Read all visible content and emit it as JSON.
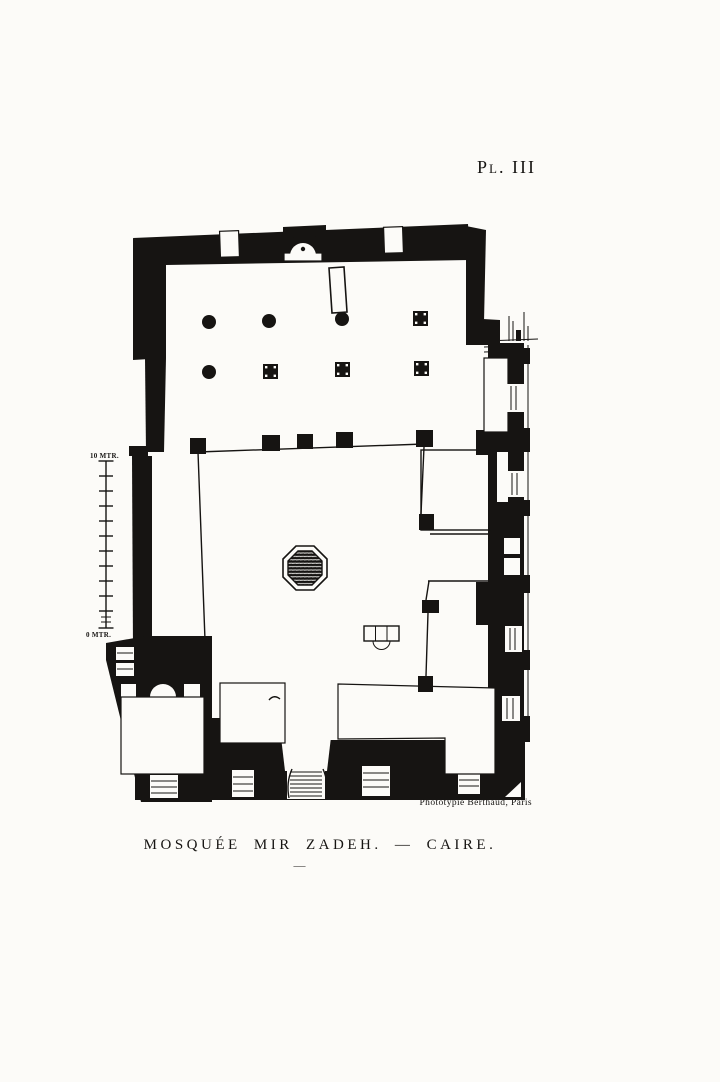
{
  "plate": {
    "label": "Pl. III",
    "caption": "MOSQUÉE MIR ZADEH. — CAIRE.",
    "caption_rule": "—",
    "credit": "Phototypie Berthaud, Paris"
  },
  "scale_bar": {
    "top_label": "10 MTR.",
    "bottom_label": "0 MTR."
  },
  "plan": {
    "type": "architectural-floor-plan",
    "subject": "Mosquée Mir Zadeh",
    "location": "Caire"
  },
  "colors": {
    "paper": "#fcfbf8",
    "ink": "#161412"
  }
}
